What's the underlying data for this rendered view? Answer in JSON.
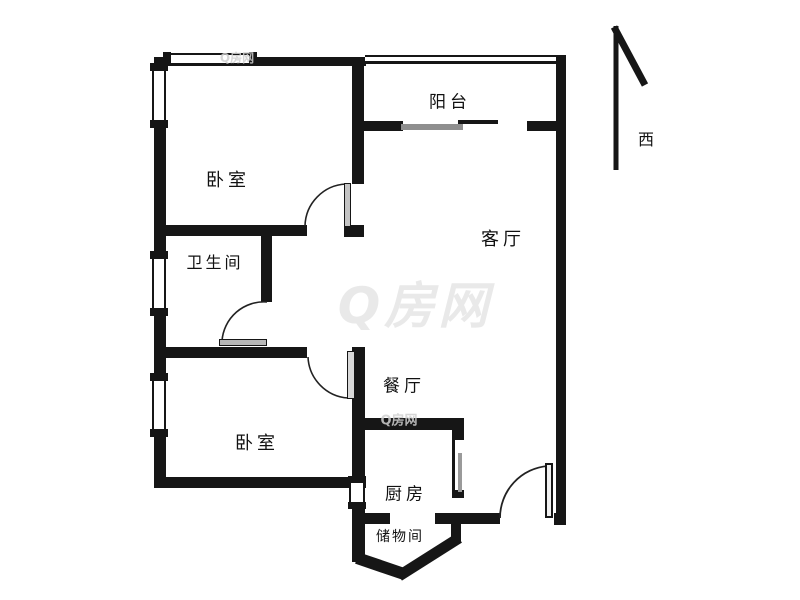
{
  "floorplan": {
    "rooms": {
      "balcony": "阳台",
      "bedroom_top": "卧室",
      "living": "客厅",
      "bathroom": "卫生间",
      "dining": "餐厅",
      "bedroom_bottom": "卧室",
      "kitchen": "厨房",
      "storage": "储物间"
    },
    "compass": {
      "direction_label": "西"
    },
    "watermark": {
      "text": "Q房网"
    },
    "colors": {
      "wall": "#161616",
      "door_leaf": "#c4c4c4",
      "watermark_large": "#e9e9e9",
      "watermark_small": "#d0d0d0",
      "background": "#ffffff",
      "text": "#111111"
    }
  }
}
